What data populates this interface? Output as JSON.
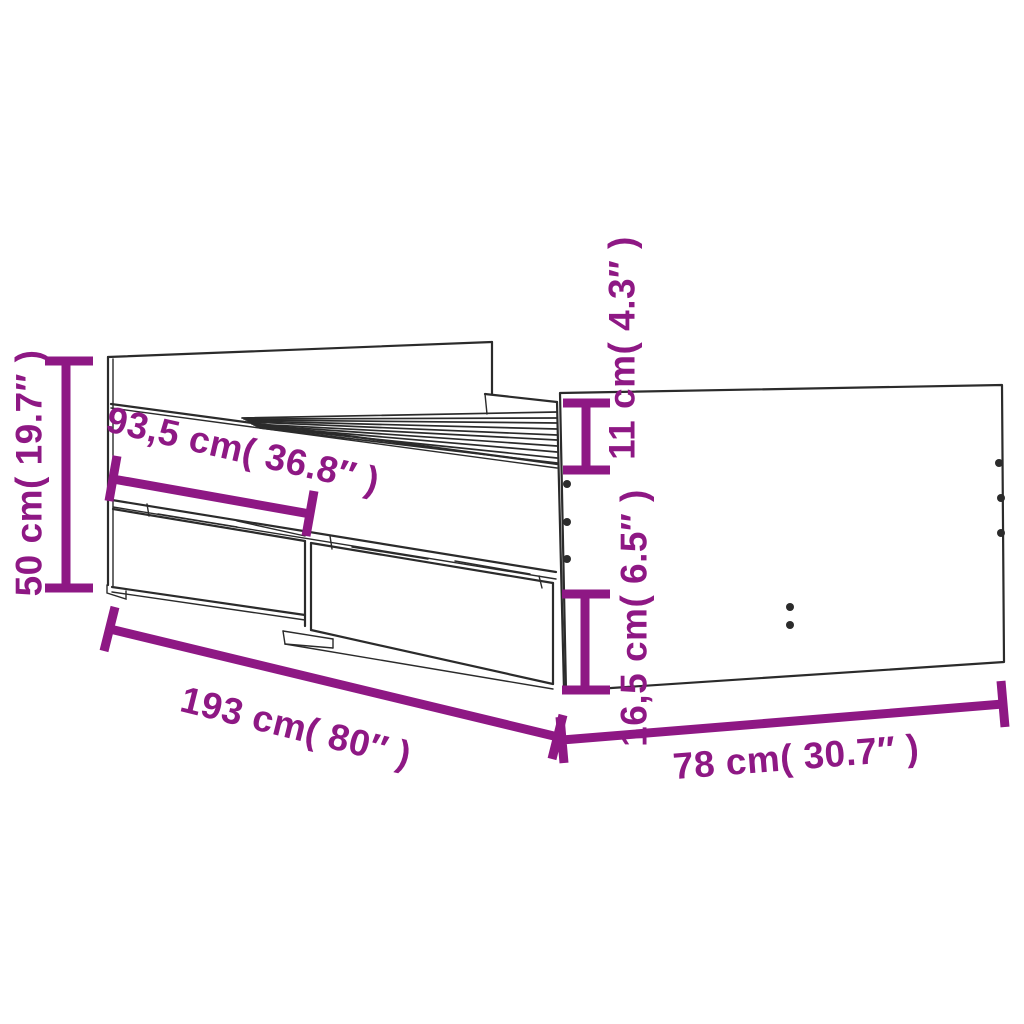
{
  "colors": {
    "accent": "#8E1884",
    "line": "#2B2B2B",
    "background": "#FFFFFF"
  },
  "diagram": {
    "subject": "bed-frame-with-drawers",
    "dimensions": [
      {
        "id": "overall-height",
        "label": "50 cm( 19.7″ )"
      },
      {
        "id": "headboard-span",
        "label": "93,5 cm( 36.8″ )"
      },
      {
        "id": "side-rail-height",
        "label": "11 cm( 4.3″ )"
      },
      {
        "id": "drawer-height",
        "label": "16,5 cm( 6.5″ )"
      },
      {
        "id": "overall-length",
        "label": "193 cm( 80″ )"
      },
      {
        "id": "overall-width",
        "label": "78 cm( 30.7″ )"
      }
    ]
  }
}
